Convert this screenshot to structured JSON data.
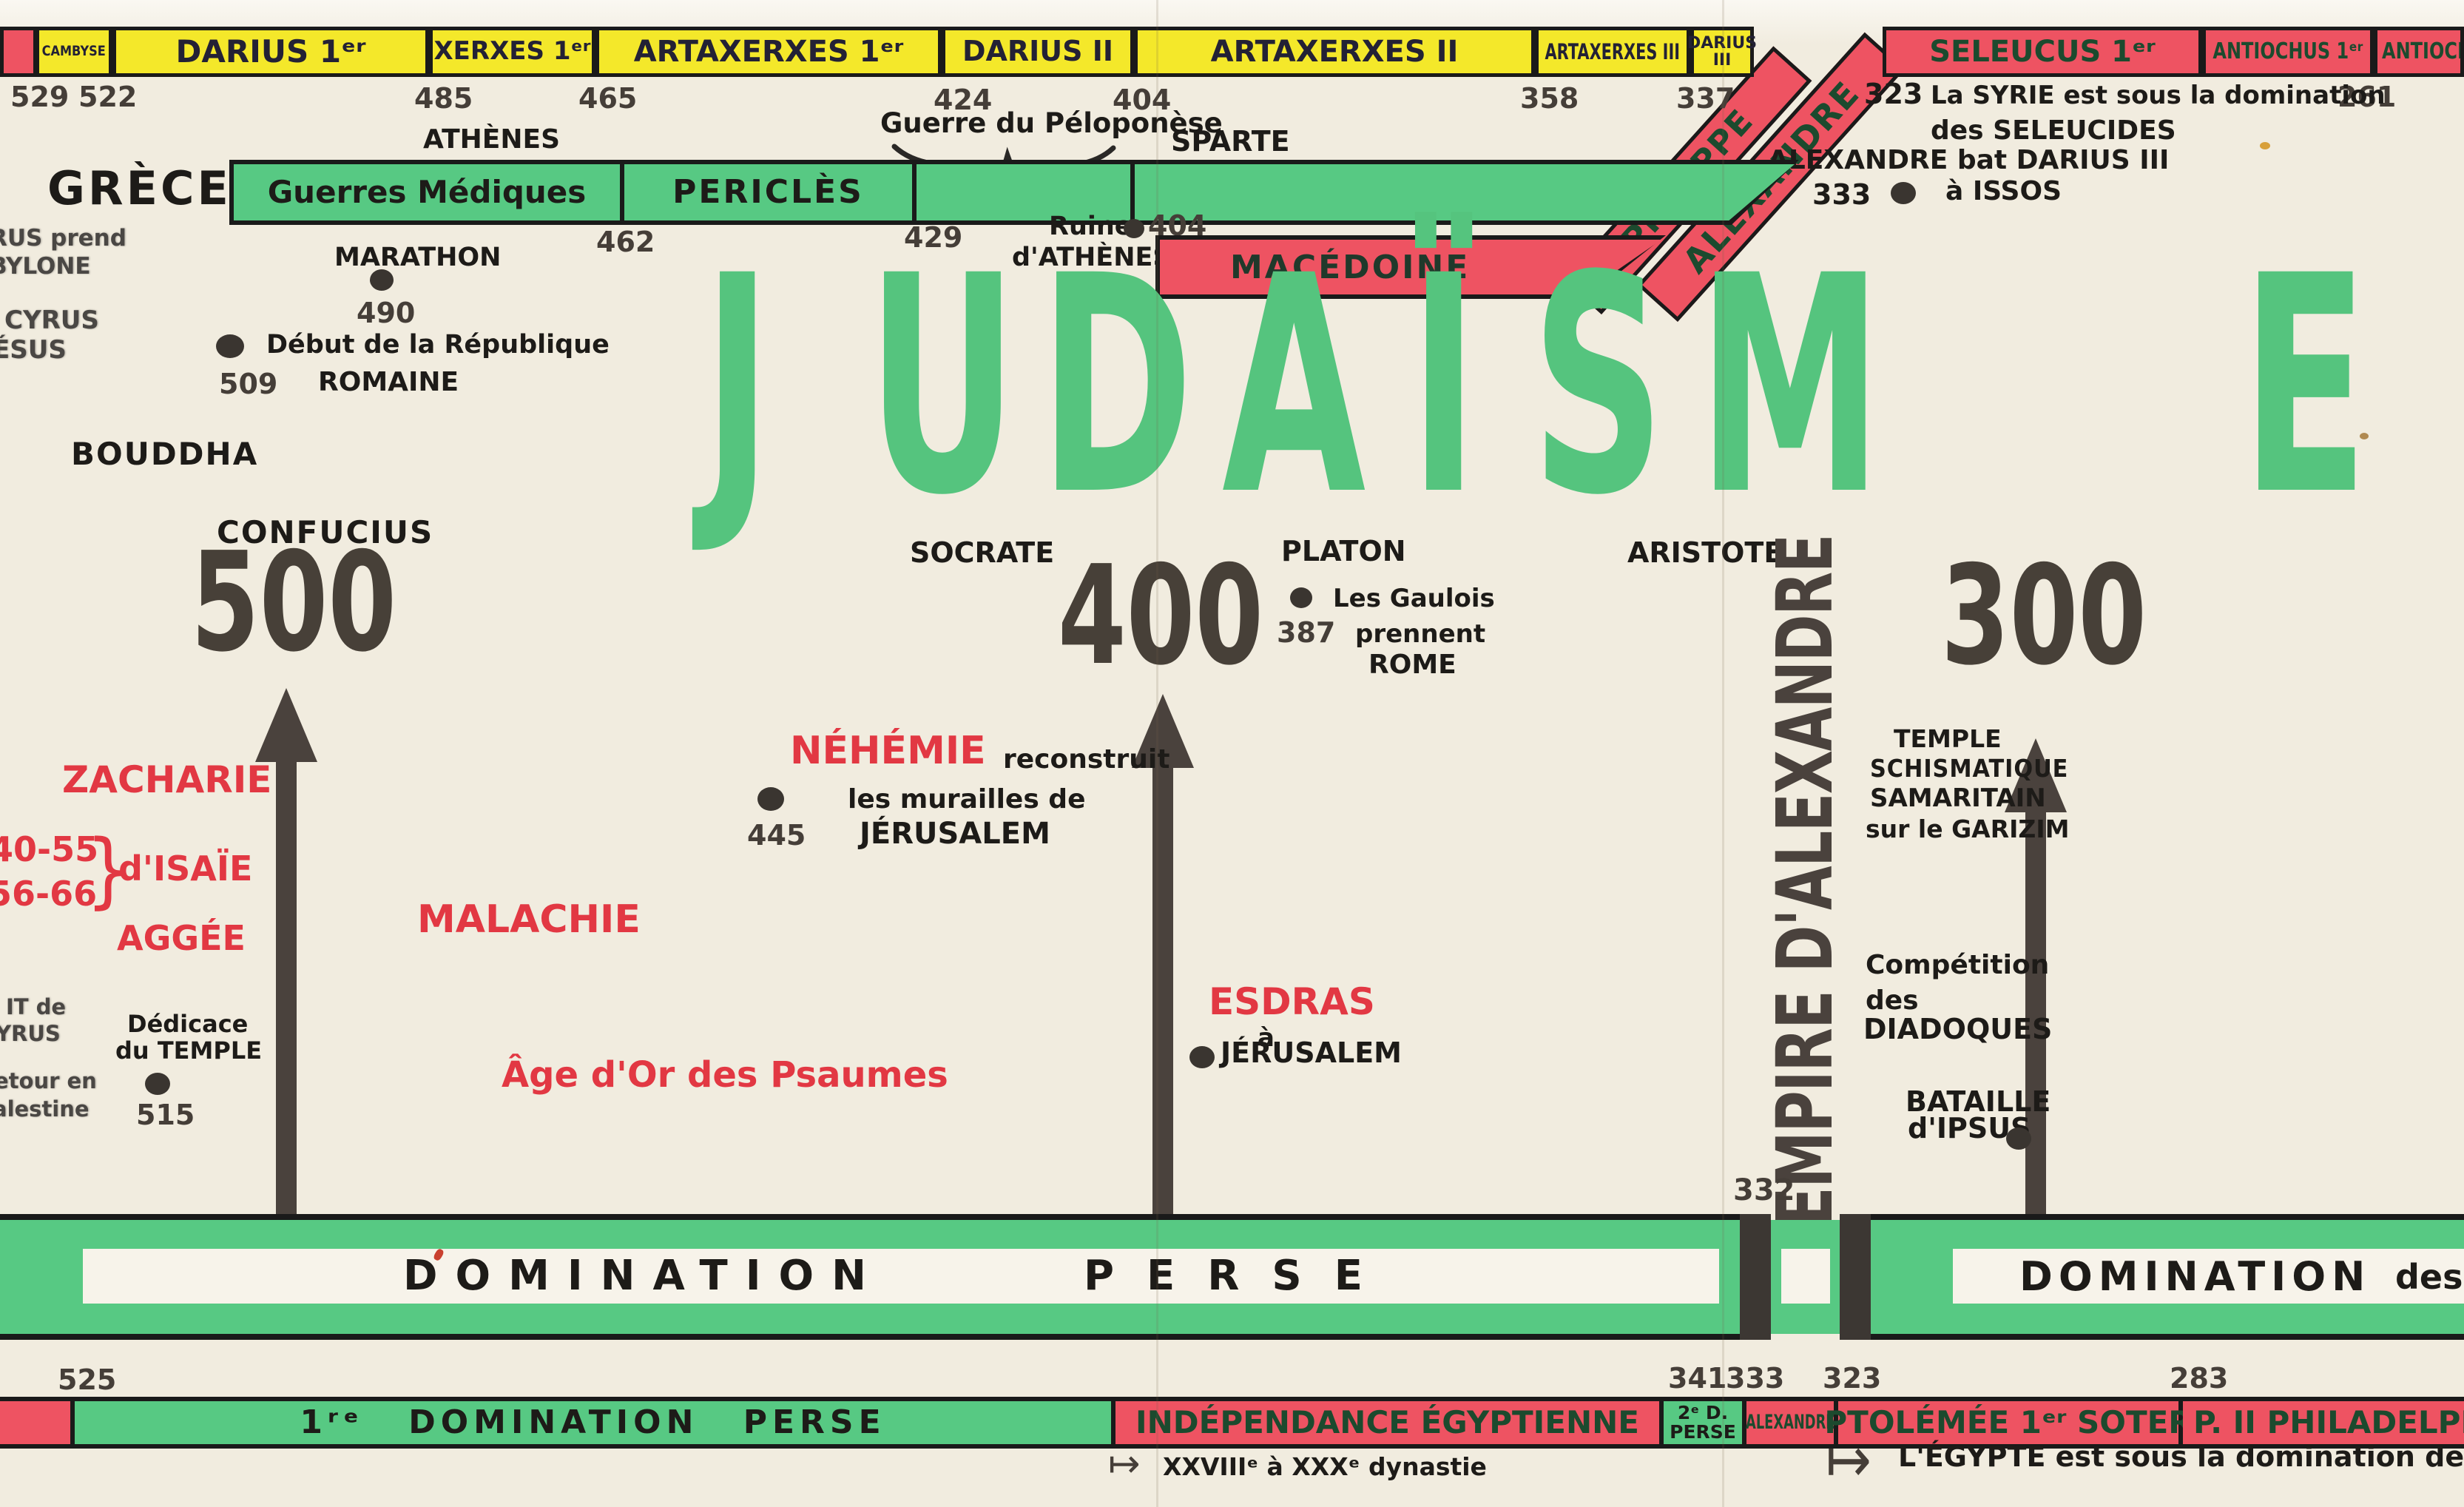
{
  "title": {
    "text": "JUDAÏSME"
  },
  "top_bar": {
    "cambyse": "CAMBYSE",
    "darius1": "DARIUS 1ᵉʳ",
    "xerxes1": "XERXES 1ᵉʳ",
    "artaxerxes1": "ARTAXERXES 1ᵉʳ",
    "darius2": "DARIUS II",
    "artaxerxes2": "ARTAXERXES II",
    "artaxerxes3": "ARTAXERXES III",
    "darius3_l1": "DARIUS",
    "darius3_l2": "III",
    "alexandre": "ALEXANDRE",
    "seleucus1": "SELEUCUS 1ᵉʳ",
    "antiochus1": "ANTIOCHUS 1ᵉʳ",
    "antiochus2": "ANTIOCHUS"
  },
  "top_dates": {
    "d529": "529",
    "d522": "522",
    "d485": "485",
    "d465": "465",
    "d424": "424",
    "d404": "404",
    "d358": "358",
    "d337": "337",
    "d261": "261"
  },
  "syria_note": {
    "date": "323",
    "line1": "La SYRIE est sous la domination",
    "line2": "des SELEUCIDES"
  },
  "greece": {
    "label": "GRÈCE",
    "athenes": "ATHÈNES",
    "pelopo": "Guerre du Péloponèse",
    "sparte": "SPARTE",
    "guerres_mediques": "Guerres Médiques",
    "pericles": "PERICLÈS",
    "d462": "462",
    "d429": "429",
    "marathon": "MARATHON",
    "d490": "490",
    "republique": "Début de la République",
    "romaine": "ROMAINE",
    "d509": "509",
    "ruine1": "Ruine",
    "ruine2": "d'ATHÈNES",
    "d404b": "404",
    "macedoine": "MACÉDOINE",
    "philippe": "PHILIPPE",
    "alexandre": "ALEXANDRE",
    "issos1": "ALEXANDRE bat DARIUS III",
    "issos2": "à ISSOS",
    "d333": "333"
  },
  "left_margin": {
    "cut1": "RUS prend",
    "cut2": "BYLONE",
    "cut3": "CYRUS",
    "cut4": "ÉSUS",
    "bouddha": "BOUDDHA",
    "confucius": "CONFUCIUS",
    "cut5": "IT de",
    "cut6": "YRUS",
    "cut7": "etour en",
    "cut8": "alestine",
    "dedicace1": "Dédicace",
    "dedicace2": "du TEMPLE",
    "d515": "515"
  },
  "prophets": {
    "zacharie": "ZACHARIE",
    "r1": "40-55",
    "r2": "56-66",
    "brace": "}",
    "isaie": "d'ISAÏE",
    "aggee": "AGGÉE",
    "malachie": "MALACHIE",
    "age_or": "Âge d'Or des Psaumes",
    "nehemie": "NÉHÉMIE",
    "reconstruit": "reconstruit",
    "murailles": "les murailles de",
    "jerusalem": "JÉRUSALEM",
    "d445": "445",
    "esdras": "ESDRAS",
    "a": "à",
    "jerusalem2": "JÉRUSALEM"
  },
  "centuries": {
    "c500": "500",
    "c400": "400",
    "c300": "300"
  },
  "philosophers": {
    "socrate": "SOCRATE",
    "platon": "PLATON",
    "aristote": "ARISTOTE",
    "gaulois1": "Les Gaulois",
    "gaulois2": "prennent",
    "gaulois3": "ROME",
    "d387": "387"
  },
  "alexander": {
    "empire": "EMPIRE D'ALEXANDRE",
    "temple1": "TEMPLE",
    "temple2": "SCHISMATIQUE",
    "temple3": "SAMARITAIN",
    "temple4": "sur le GARIZIM",
    "comp1": "Compétition",
    "comp2": "des",
    "comp3": "DIADOQUES",
    "bataille1": "BATAILLE",
    "bataille2": "d'IPSUS",
    "d332": "332"
  },
  "persia_band": {
    "domination": "DOMINATION",
    "perse": "PERSE",
    "domination2": "DOMINATION",
    "des": "des",
    "d525": "525",
    "d341": "341",
    "d333": "333",
    "d323": "323",
    "d283": "283"
  },
  "egypt_strip": {
    "first": "1ʳᵉ DOMINATION PERSE",
    "independance": "INDÉPENDANCE ÉGYPTIENNE",
    "perse2_l1": "2ᵉ D.",
    "perse2_l2": "PERSE",
    "alexandre": "ALEXANDRE",
    "ptolemee": "PTOLÉMÉE 1ᵉʳ SOTER",
    "philadelphe": "P. II PHILADELPH",
    "arrow": "↦",
    "dynastie": "XXVIIIᵉ à XXXᵉ dynastie",
    "lagides": "L'ÉGYPTE est sous la domination des LAGIDES"
  },
  "colors": {
    "yellow": "#f4e82a",
    "red": "#ee5362",
    "green": "#57c983",
    "title_green": "#55c47e",
    "prophet_red": "#e23843",
    "dark": "#4a423d",
    "cream": "#f1ecdf"
  }
}
